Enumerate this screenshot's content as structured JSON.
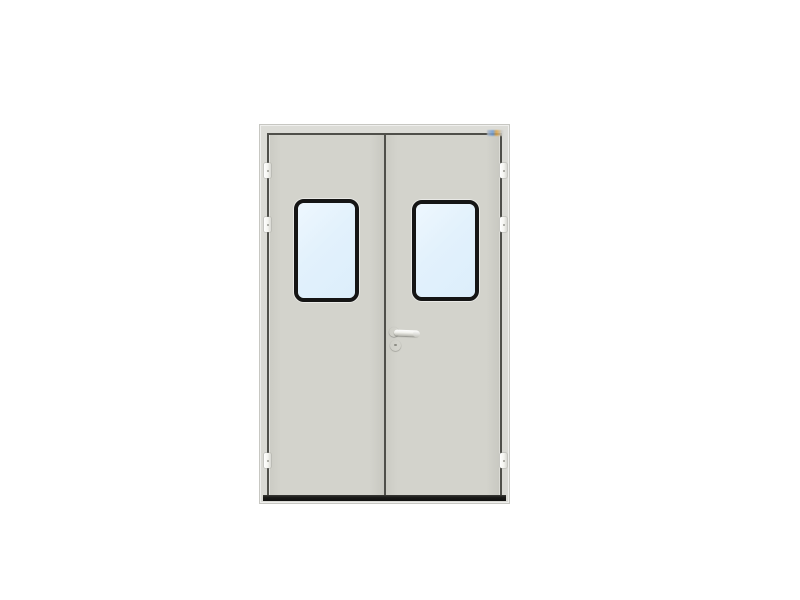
{
  "scene": {
    "background": "#ffffff",
    "description": "Front view of a light-grey double swing door with two black-framed rounded vision windows, three hinges per side, a lever handle with round escutcheon on the right leaf, and a dark threshold",
    "subject": "double-leaf steel cleanroom door",
    "leaf_count": 2,
    "window_count": 2,
    "hinge_count_per_side": 3,
    "watermark_present": true
  },
  "door": {
    "colors": {
      "background": "#ffffff",
      "frame": "#dcdcd7",
      "frame_edge": "#c7c7c2",
      "gap": "#4f4f4a",
      "leaf": "#d3d3cc",
      "threshold": "#191917",
      "window_frame": "#151515",
      "glass": "#e2f1fc",
      "glass_light": "#eef7fe",
      "hinge": "#f4f4f0",
      "hardware": "#ededе8",
      "watermark_blue": "#6a9bd8",
      "watermark_orange": "#e0a23e"
    }
  }
}
